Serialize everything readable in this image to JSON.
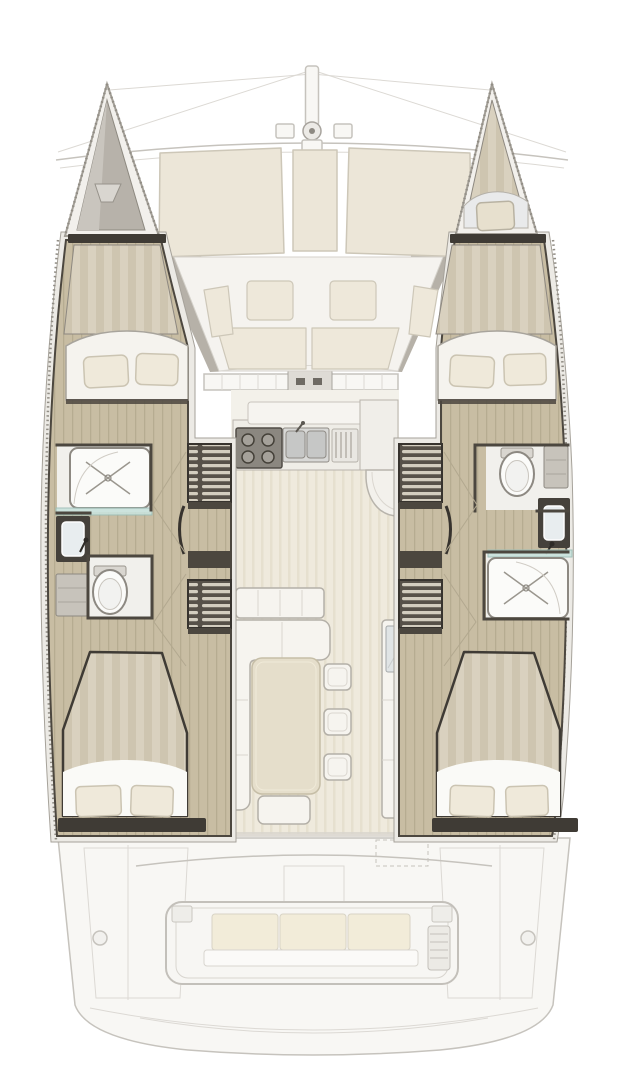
{
  "meta": {
    "title": "Catamaran interior layout deck plan",
    "view": "top-down",
    "vessel_type": "sailing catamaran, 4-cabin / 2-head layout"
  },
  "palette": {
    "ghost_line": "#c6c3bd",
    "ghost_line_soft": "#dcd9d4",
    "ghost_fill": "#f8f7f4",
    "pad_cream": "#ece6d8",
    "pad_border": "#cdc7b8",
    "cockpit_cream": "#eee8da",
    "gray_wedge": "#b6b1a8",
    "gunwale": "#eceae5",
    "gunwale_line": "#a6a29a",
    "wood": "#c8bda3",
    "wood_line": "#b2a78c",
    "stripe_a": "#d9d1bf",
    "stripe_b": "#cec5b0",
    "bed_white": "#f5f3ee",
    "pillow": "#efe9da",
    "pillow_border": "#cbc4b2",
    "wall_dark": "#4c473f",
    "sill_dark": "#3f3b35",
    "bath_floor": "#f1f0ec",
    "fixture_white": "#fbfbf9",
    "fixture_border": "#8d8982",
    "vanity_dark": "#45413b",
    "sink_light": "#e8edef",
    "glass_teal": "#c8e2dc",
    "stair_dark": "#575149",
    "stair_rib": "#d3cdbf",
    "floor_cream": "#efeadd",
    "floor_line": "#e4ddcc",
    "table_tan": "#e5decb",
    "table_border": "#c6bea7",
    "unit_white": "#f6f4ef",
    "unit_border": "#b4b0a8",
    "steel": "#d8d8d6",
    "stove_dark": "#8b8780",
    "burner": "#a5a19a"
  },
  "features": {
    "plan": "Catamaran interior layout deck plan, overhead view",
    "rigging": "Bowsprit pole, furler and forestay rigging",
    "crossbeam": "Forward crossbeam",
    "foredeck_sunpads": "Foredeck sun pads",
    "forward_cockpit": "Forward cockpit seating area",
    "forward_cockpit_tables": "Forward cockpit low tables",
    "windshield": "Saloon front windows and sliding door",
    "saloon": "Saloon with galley and dinette",
    "galley_stove": "Galley four-burner stove",
    "galley_sink": "Galley double sink with faucet",
    "galley_rack": "Galley drain rack",
    "galley_counter": "Galley counter with rounded end",
    "sideboard": "Saloon sideboard",
    "dinette_sofa": "L-shaped saloon sofa",
    "dinette_table": "Saloon dining table",
    "stools": "Three saloon stools",
    "aft_bench": "Saloon aft bench seat",
    "nav_cabinet": "Starboard-side cabinet with glass top",
    "port_hull": "Port hull (left)",
    "starboard_hull": "Starboard hull (right)",
    "port_bow_locker": "Port bow anchor locker",
    "starboard_bow_berth": "Starboard bow skipper berth",
    "port_forward_cabin": "Port forward double cabin",
    "starboard_forward_cabin": "Starboard forward double cabin",
    "port_head": "Port bathroom (head)",
    "starboard_head": "Starboard bathroom (head)",
    "port_shower": "Port shower with drain",
    "starboard_shower": "Starboard shower with drain",
    "port_toilet": "Port marine toilet",
    "starboard_toilet": "Starboard marine toilet",
    "port_vanity": "Port washbasin vanity",
    "starboard_vanity": "Starboard washbasin vanity",
    "port_companionway": "Port companionway steps",
    "starboard_companionway": "Starboard companionway steps",
    "port_aft_cabin": "Port aft double cabin",
    "starboard_aft_cabin": "Starboard aft double cabin",
    "aft_cockpit": "Aft cockpit (ghosted)",
    "aft_cockpit_bench": "Aft cockpit bench with three cushions",
    "transom_platform": "Transom steps and swim platform"
  }
}
